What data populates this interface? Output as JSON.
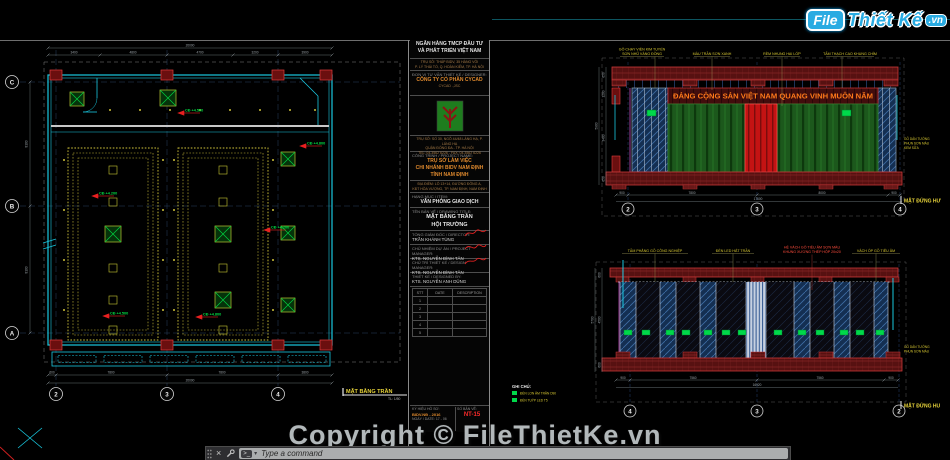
{
  "watermark": {
    "logo_file": "File",
    "logo_name": "Thiết Kế",
    "logo_tld": ".vn",
    "copyright": "Copyright © FileThietKe.vn"
  },
  "command_bar": {
    "close_icon": "×",
    "placeholder": "Type a command"
  },
  "colors": {
    "wall_cyan": "#19c8e0",
    "coffer_yellow": "#cfc23a",
    "fixture_green": "#00d040",
    "column_red": "#b01c1c",
    "band_red": "#571111",
    "banner_text": "#ff7a1a",
    "panel_blue": "#142f52",
    "level_green": "#00dd44",
    "logo_blue": "#29abe2"
  },
  "plan": {
    "title": "MẶT BẰNG TRẦN",
    "scale": "TL: 1/50",
    "grid_rows": [
      "C",
      "B",
      "A"
    ],
    "grid_cols": [
      "2",
      "3",
      "4"
    ],
    "levels": [
      "CĐ +4.500",
      "CĐ +4.200",
      "CĐ +4.800",
      "CĐ +4.500",
      "CĐ +4.800",
      "CĐ +4.200"
    ],
    "dims_top": [
      "3400",
      "4800",
      "4700",
      "3200",
      "3900"
    ],
    "dims_top_overall": "20000",
    "dims_bottom": [
      "600",
      "7800",
      "7800",
      "3800"
    ],
    "dims_bottom_overall": "20000",
    "dims_left": [
      "8100",
      "8100"
    ]
  },
  "title_block": {
    "client_line1": "NGÂN HÀNG TMCP ĐẦU TƯ",
    "client_line2": "VÀ PHÁT TRIỂN VIỆT NAM",
    "client_addr1": "TRỤ SỞ: THÁP BIDV, 35 HÀNG VÔI",
    "client_addr2": "P. LÝ THÁI TỔ, Q. HOÀN KIẾM, TP. HÀ NỘI",
    "designer_label": "ĐƠN VỊ TƯ VẤN THIẾT KẾ / DESIGNER:",
    "designer_name": "CÔNG TY CỔ PHẦN CYCAD",
    "designer_sub": "CYCAD .,JSC",
    "designer_addr1": "TRỤ SỞ: SỐ 30, NGÕ 44/48 LÁNG HẠ, P. LÁNG HẠ",
    "designer_addr2": "QUẬN ĐỐNG ĐA - TP. HÀ NỘI",
    "designer_addr3": "TEL: 04.3562 6226 - FAX: 04.3562 6226",
    "project_label": "CÔNG TRÌNH / PROJECT NAME:",
    "project_line1": "TRỤ SỞ LÀM VIỆC",
    "project_line2": "CHI NHÁNH BIDV NAM ĐỊNH",
    "project_line3": "TỈNH NAM ĐỊNH",
    "location1": "ĐỊA ĐIỂM: LÔ 13+14, ĐƯỜNG ĐÔNG A,",
    "location2": "KĐT HÒA VƯỢNG, TP. NAM ĐỊNH, NAM ĐỊNH",
    "item_label": "HẠNG MỤC / ITEM:",
    "item_value": "VĂN PHÒNG GIAO DỊCH",
    "drawing_label": "TÊN BẢN VẼ / DRAWING TITLE:",
    "drawing_line1": "MẶT BẰNG TRẦN",
    "drawing_line2": "HỘI TRƯỜNG",
    "director_label": "TỔNG GIÁM ĐỐC / DIRECTOR:",
    "director_name": "TRẦN KHÁNH TÙNG",
    "pm_label": "CHỦ NHIỆM DỰ ÁN / PROJECT MANAGER:",
    "pm_name": "KTS. NGUYỄN ĐÌNH TÂN",
    "lead_label": "CHỦ TRÌ THIẾT KẾ / DESIGN MANAGER:",
    "lead_name": "KTS. NGUYỄN ĐÌNH TÂN",
    "designed_label": "THIẾT KẾ / DESIGNED BY:",
    "designed_name": "KTS. NGUYỄN ANH DŨNG",
    "table": {
      "col1": "STT",
      "col2": "DATE",
      "col3": "DESCRIPTION",
      "rows": [
        "1",
        "2",
        "3",
        "4",
        "5"
      ]
    },
    "issue_label": "KÝ HIỆU HỒ SƠ:",
    "issue_value": "BIDV.NĐ - 2016",
    "date_label": "NGÀY / DATE:",
    "date_value": "17 - 06",
    "number_label": "SỐ BẢN VẼ:",
    "number_value": "NT-15"
  },
  "elev1": {
    "banner": "ĐẢNG CỘNG SẢN VIỆT NAM QUANG VINH MUÔN NĂM",
    "callout1a": "GỖ CHẠY VIỀN KIM TUYẾN",
    "callout1b": "SƠN NHŨ VÀNG ĐỒNG",
    "callout2": "MÀU TRẦN SƠN XANH",
    "callout3": "RÈM NHUNG HAI LỚP",
    "callout4": "TẤM THẠCH CAO KHUNG CHÌM",
    "grid": [
      "2",
      "3",
      "4"
    ],
    "dims_bottom": [
      "900",
      "7800",
      "8000",
      "900"
    ],
    "overall": "17600",
    "dims_left": [
      "650",
      "1200",
      "3400",
      "650"
    ],
    "overall_left": "5900",
    "side_note1": "GỖ DÁN TƯỜNG",
    "side_note2": "PHUN SƠN MÀU",
    "side_note3": "KEM SỮA",
    "title_cut": "MẶT ĐỨNG HƯ"
  },
  "elev2": {
    "callout1": "TẤM PHẲNG GỖ CÔNG NGHIỆP",
    "callout2": "ĐÈN LED HẮT TRẦN",
    "callout3a": "HỆ VÁCH GỖ TIÊU ÂM SƠN MÀU",
    "callout3b": "KHUNG XƯƠNG THÉP HỘP 20x20",
    "callout4": "VÁCH ỐP GỖ TIÊU ÂM",
    "grid": [
      "4",
      "3",
      "2"
    ],
    "dims_bottom": [
      "900",
      "7560",
      "7560",
      "900"
    ],
    "overall": "16920",
    "dims_left": [
      "600",
      "4500",
      "600"
    ],
    "overall_left": "5700",
    "legend_title": "GHI CHÚ:",
    "legend1": "ĐÈN LON ÂM TRẦN D90",
    "legend2": "ĐÈN TUÝP LED T5",
    "side_note1": "GỖ DÁN TƯỜNG",
    "side_note2": "PHUN SƠN MÀU",
    "title_cut": "MẶT ĐỨNG HU"
  }
}
